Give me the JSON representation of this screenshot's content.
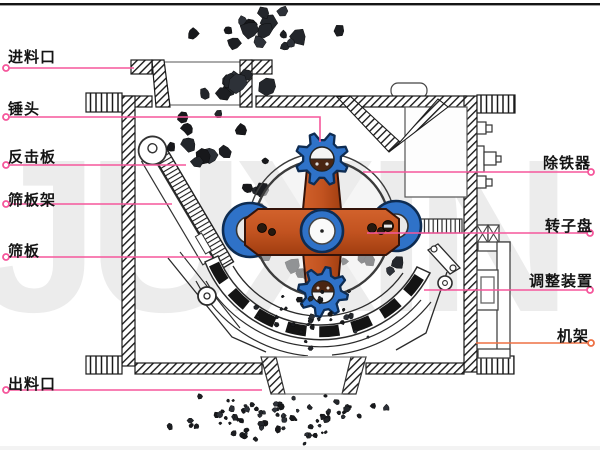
{
  "title": "hammer-crusher-structure-diagram",
  "watermark": "JUXIN",
  "colors": {
    "label_text": "#141414",
    "label_line": "#f5569b",
    "frame_line": "#ed7044",
    "hammer_blue": "#2f72c8",
    "hammer_blue_dark": "#0e2c52",
    "rotor_orange": "#c25320",
    "watermark_gray": "#ececec",
    "outline_black": "#1b1b1b",
    "rock_dark": "#1c1e22"
  },
  "labels": {
    "left": [
      {
        "id": "feed-inlet",
        "text": "进料口",
        "x": 8,
        "y": 46,
        "line": [
          [
            6,
            68
          ],
          [
            134,
            68
          ]
        ],
        "ring": [
          6,
          68
        ]
      },
      {
        "id": "hammer-head",
        "text": "锤头",
        "x": 8,
        "y": 98,
        "line": [
          [
            6,
            117
          ],
          [
            320,
            117
          ],
          [
            320,
            142
          ]
        ],
        "ring": [
          6,
          117
        ]
      },
      {
        "id": "impact-plate",
        "text": "反击板",
        "x": 8,
        "y": 146,
        "line": [
          [
            6,
            165
          ],
          [
            186,
            165
          ]
        ],
        "ring": [
          6,
          165
        ]
      },
      {
        "id": "screen-frame",
        "text": "筛板架",
        "x": 8,
        "y": 189,
        "line": [
          [
            6,
            204
          ],
          [
            172,
            204
          ]
        ],
        "ring": [
          6,
          204
        ]
      },
      {
        "id": "screen-plate",
        "text": "筛板",
        "x": 8,
        "y": 240,
        "line": [
          [
            6,
            257
          ],
          [
            212,
            257
          ]
        ],
        "ring": [
          6,
          257
        ]
      },
      {
        "id": "discharge-outlet",
        "text": "出料口",
        "x": 8,
        "y": 373,
        "line": [
          [
            6,
            390
          ],
          [
            262,
            390
          ]
        ],
        "ring": [
          6,
          390
        ]
      }
    ],
    "right": [
      {
        "id": "iron-remover",
        "text": "除铁器",
        "x": 543,
        "y": 152,
        "line": [
          [
            363,
            172
          ],
          [
            591,
            172
          ]
        ],
        "ring": [
          591,
          172
        ]
      },
      {
        "id": "rotor-disc",
        "text": "转子盘",
        "x": 545,
        "y": 215,
        "line": [
          [
            367,
            233
          ],
          [
            590,
            233
          ]
        ],
        "ring": [
          590,
          233
        ]
      },
      {
        "id": "adjusting-device",
        "text": "调整装置",
        "x": 529,
        "y": 270,
        "line": [
          [
            424,
            290
          ],
          [
            590,
            290
          ]
        ],
        "ring": [
          590,
          290
        ]
      },
      {
        "id": "machine-frame",
        "text": "机架",
        "x": 557,
        "y": 325,
        "line": [
          [
            476,
            343
          ],
          [
            591,
            343
          ]
        ],
        "ring": [
          591,
          343
        ],
        "line_color": "#ed7044"
      }
    ]
  },
  "illustration": {
    "rock_clusters_behind": [
      {
        "name": "feed-falling-rocks",
        "type": "box",
        "x": 172,
        "y": 5,
        "w": 190,
        "h": 53,
        "count": 16,
        "smin": 4,
        "smax": 11,
        "seed": 7
      },
      {
        "name": "hopper-rocks",
        "type": "box",
        "x": 165,
        "y": 62,
        "w": 140,
        "h": 40,
        "count": 9,
        "smin": 4,
        "smax": 12,
        "seed": 11
      },
      {
        "name": "impact-stream-rocks",
        "type": "line",
        "x1": 182,
        "y1": 112,
        "x2": 296,
        "y2": 258,
        "jx": 36,
        "jy": 14,
        "count": 24,
        "smin": 3,
        "smax": 9,
        "seed": 23
      },
      {
        "name": "chamber-rocks",
        "type": "box",
        "x": 245,
        "y": 233,
        "w": 215,
        "h": 66,
        "count": 16,
        "smin": 3,
        "smax": 8,
        "seed": 31
      }
    ],
    "rock_clusters_front": [
      {
        "name": "sieve-drip-particles",
        "type": "box",
        "x": 248,
        "y": 283,
        "w": 122,
        "h": 70,
        "count": 32,
        "smin": 1.5,
        "smax": 3.5,
        "seed": 41
      },
      {
        "name": "discharge-spray-particles",
        "type": "box",
        "x": 150,
        "y": 392,
        "w": 262,
        "h": 52,
        "count": 78,
        "smin": 1.5,
        "smax": 4,
        "seed": 53
      }
    ]
  }
}
